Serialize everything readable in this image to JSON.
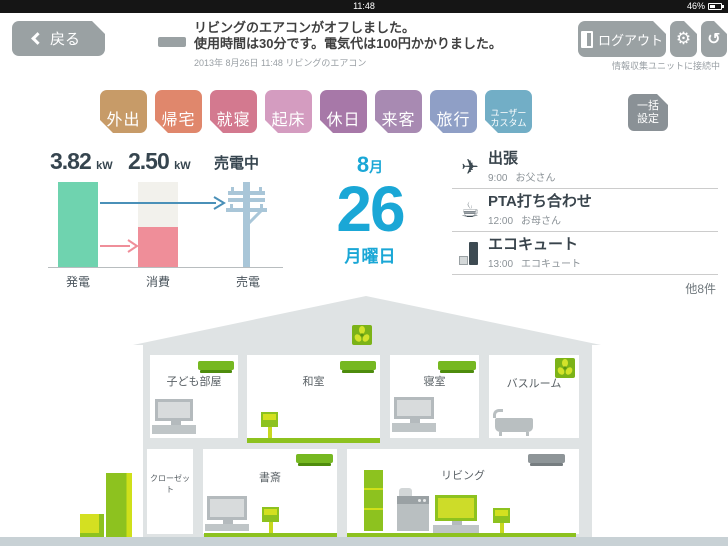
{
  "statusbar": {
    "time": "11:48",
    "battery": "46%"
  },
  "header": {
    "back_label": "戻る",
    "notification": {
      "line1": "リビングのエアコンがオフしました。",
      "line2": "使用時間は30分です。電気代は100円かかりました。",
      "timestamp": "2013年 8月26日 11:48  リビングのエアコン"
    },
    "logout_label": "ログアウト",
    "connection_status": "情報収集ユニットに接続中"
  },
  "icons": {
    "gear": "⚙",
    "refresh": "↺",
    "plane": "✈",
    "cup": "☕"
  },
  "modes": {
    "items": [
      {
        "label": "外出",
        "color": "#c79b68"
      },
      {
        "label": "帰宅",
        "color": "#e0876c"
      },
      {
        "label": "就寝",
        "color": "#d3798f"
      },
      {
        "label": "起床",
        "color": "#d49cc0"
      },
      {
        "label": "休日",
        "color": "#a778a8"
      },
      {
        "label": "来客",
        "color": "#a88ab2"
      },
      {
        "label": "旅行",
        "color": "#8f9fc6"
      }
    ],
    "custom": {
      "line1": "ユーザー",
      "line2": "カスタム",
      "color": "#72aec6"
    },
    "batch": {
      "line1": "一括",
      "line2": "設定",
      "color": "#8a9196"
    }
  },
  "energy": {
    "generation": {
      "value": "3.82",
      "unit": "kW",
      "label": "発電",
      "color": "#6fd3af"
    },
    "consumption": {
      "value": "2.50",
      "unit": "kW",
      "label": "消費",
      "color": "#ef8e99",
      "bg_color": "#f2f1ec",
      "fill_percent": 47
    },
    "sell": {
      "status": "売電中",
      "label": "売電",
      "pole_color": "#a9c6d8"
    }
  },
  "date": {
    "month": "8",
    "month_suffix": "月",
    "day": "26",
    "weekday": "月曜日",
    "color": "#1aa7d6"
  },
  "schedule": {
    "items": [
      {
        "icon": "airplane-icon",
        "title": "出張",
        "time": "9:00",
        "person": "お父さん"
      },
      {
        "icon": "cup-icon",
        "title": "PTA打ち合わせ",
        "time": "12:00",
        "person": "お母さん"
      },
      {
        "icon": "water-heater-icon",
        "title": "エコキュート",
        "time": "13:00",
        "person": "エコキュート"
      }
    ],
    "more": "他8件"
  },
  "house": {
    "rooms": {
      "kids": "子ども部屋",
      "washitsu": "和室",
      "bedroom": "寝室",
      "bathroom": "バスルーム",
      "closet": "クローゼット",
      "study": "書斎",
      "living": "リビング"
    },
    "accent_green": "#8dc21f"
  }
}
